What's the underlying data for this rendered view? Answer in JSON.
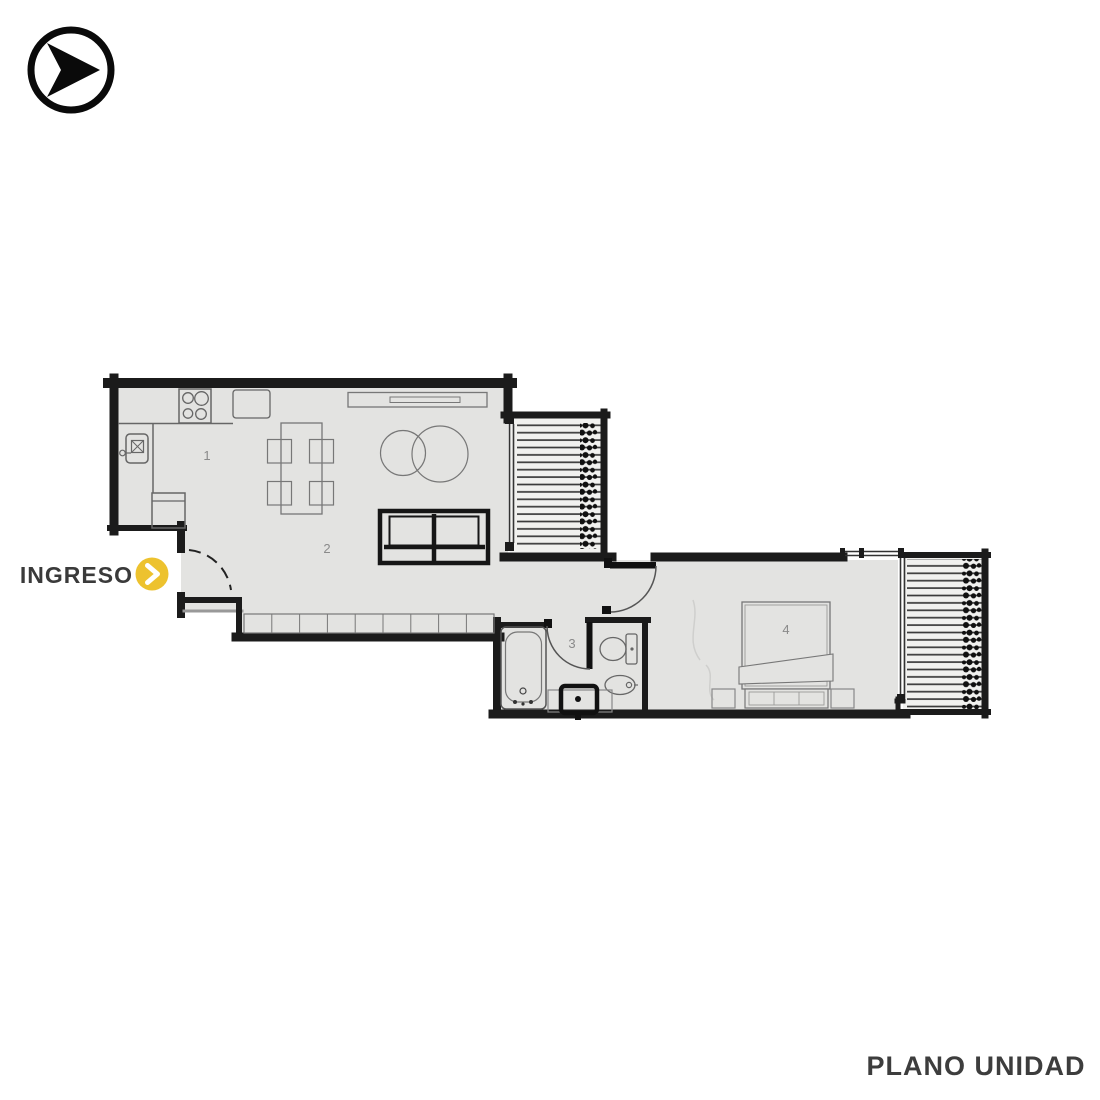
{
  "branding": {
    "logo_icon": "arrow-right-circle-icon"
  },
  "entry": {
    "label": "INGRESO",
    "arrow_icon": "chevron-right-icon",
    "arrow_color": "#EDC22E"
  },
  "footer": {
    "title": "PLANO UNIDAD"
  },
  "plan": {
    "rooms": [
      {
        "label": "1"
      },
      {
        "label": "2"
      },
      {
        "label": "3"
      },
      {
        "label": "4"
      }
    ],
    "colors": {
      "wall": "#1B1B1B",
      "floor": "#E3E3E1",
      "balcony_deck": "#F1F1EF",
      "fixture_line": "#777777",
      "label_text": "#8A8A8A",
      "accent_yellow": "#EDC22E"
    }
  }
}
